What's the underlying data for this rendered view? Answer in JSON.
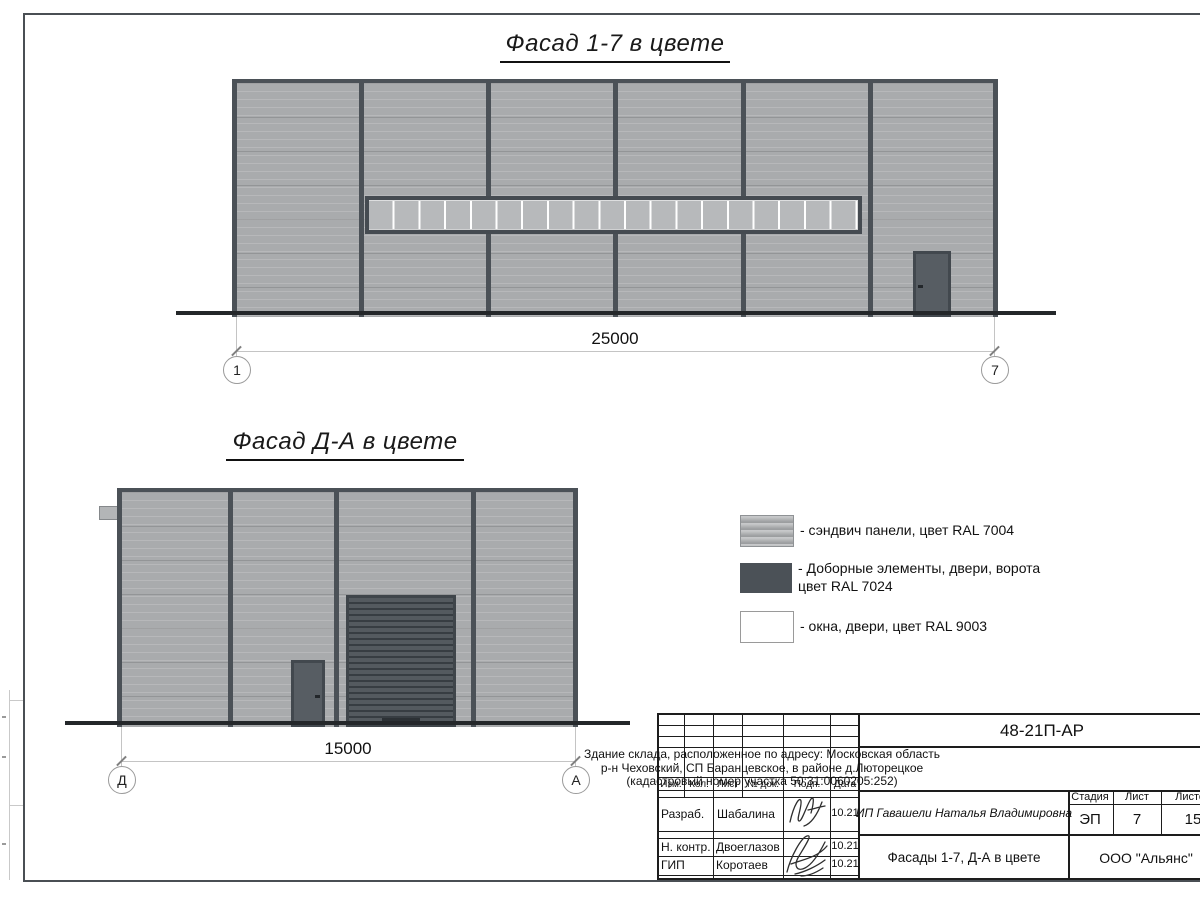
{
  "facade1": {
    "title": "Фасад 1-7 в цвете",
    "dimension": "25000",
    "marker_left": "1",
    "marker_right": "7"
  },
  "facade2": {
    "title": "Фасад Д-А в цвете",
    "dimension": "15000",
    "marker_left": "Д",
    "marker_right": "А"
  },
  "legend": {
    "item1": "- сэндвич панели, цвет RAL 7004",
    "item2_line1": "- Доборные элементы, двери, ворота",
    "item2_line2": "цвет RAL 7024",
    "item3": "- окна, двери, цвет RAL 9003"
  },
  "colors": {
    "sandwich_panel_ral7004": "#a9abad",
    "dark_elements_ral7024": "#4b5157",
    "windows_doors_ral9003": "#ffffff"
  },
  "title_block": {
    "doc_number": "48-21П-АР",
    "address_line1": "Здание склада, расположенное по адресу: Московская область",
    "address_line2": "р-н Чеховский, СП Баранцевское, в районе д.Люторецкое",
    "address_line3": "(кадастровый номер участка 50:31:0060205:252)",
    "col_izm": "Изм.",
    "col_kol": "Кол.",
    "col_list": "Лист",
    "col_doc": "№ док.",
    "col_podp": "Подп.",
    "col_data": "Дата",
    "row1_role": "Разраб.",
    "row1_name": "Шабалина",
    "row1_date": "10.21",
    "row2_role": "Н. контр.",
    "row2_name": "Двоеглазов",
    "row2_date": "10.21",
    "row3_role": "ГИП",
    "row3_name": "Коротаев",
    "row3_date": "10.21",
    "client": "ИП Гавашели Наталья Владимировна",
    "stage_label": "Стадия",
    "sheet_label": "Лист",
    "sheets_label": "Листов",
    "stage_value": "ЭП",
    "sheet_value": "7",
    "sheets_value": "15",
    "sheet_title": "Фасады 1-7, Д-А в цвете",
    "company": "ООО \"Альянс\""
  }
}
